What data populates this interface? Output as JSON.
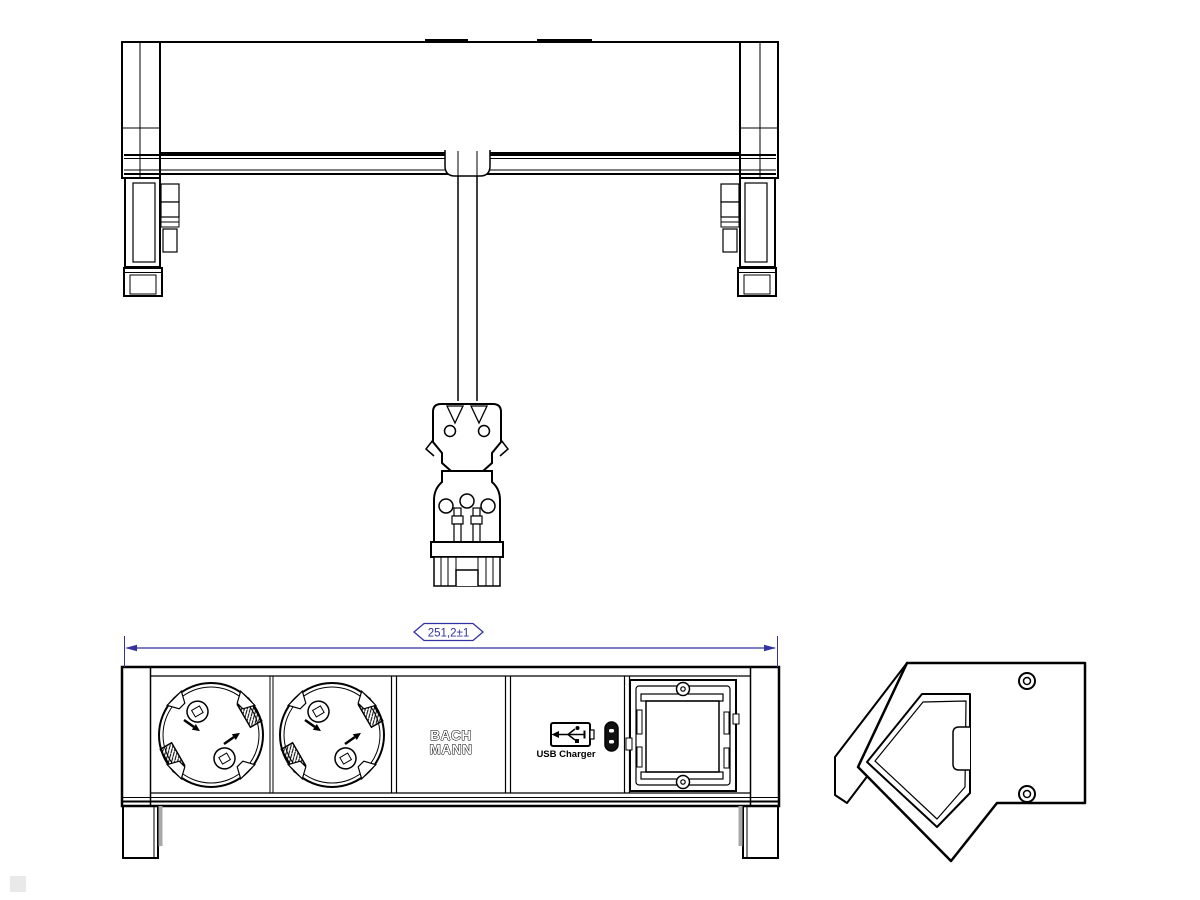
{
  "drawing": {
    "dimension_label": "251,2±1",
    "brand_logo": {
      "line1": "BACH",
      "line2": "MANN"
    },
    "usb_module_label": "USB Charger",
    "colors": {
      "line": "#000000",
      "dimension": "#3232a2",
      "shadow": "#a8a8a8",
      "background": "#ffffff"
    },
    "icons": {
      "usb_a": "usb-a-port-icon",
      "usb_c": "usb-c-port-icon",
      "screw": "screw-icon",
      "socket": "schuko-socket",
      "connector": "gst18-plug-connector"
    }
  }
}
